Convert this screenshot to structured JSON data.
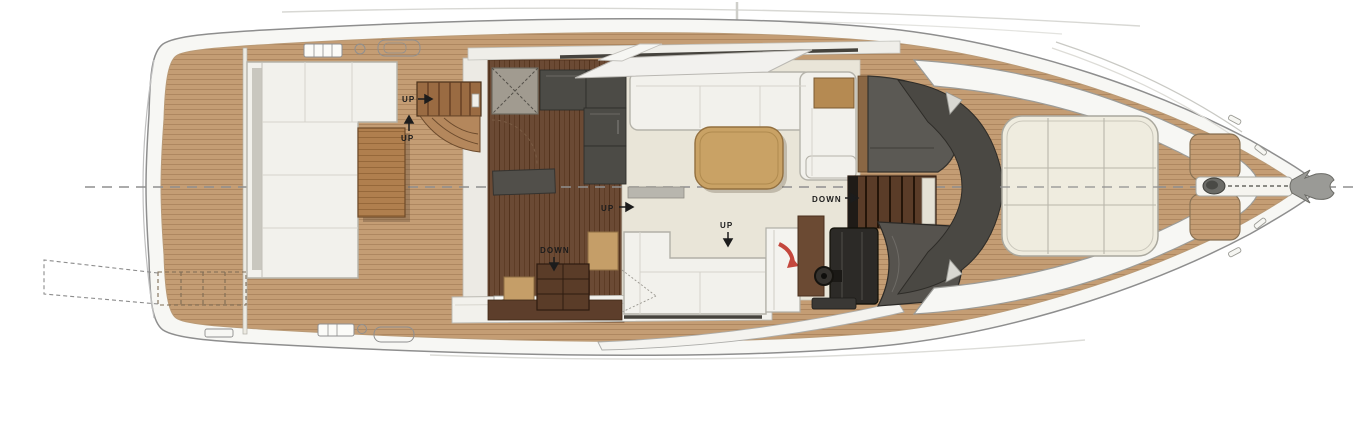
{
  "plan": {
    "type": "yacht-deck-floor-plan",
    "labels": {
      "up_flybridge": "UP",
      "up_swim": "UP",
      "up_galley": "UP",
      "up_cockpit": "UP",
      "down_cabins": "DOWN",
      "down_galley": "DOWN"
    },
    "icons": [
      "grill-icon",
      "burner-icon",
      "sink-icon",
      "skylight-hatch-icon",
      "steering-wheel-icon",
      "windlass-icon",
      "anchor-icon",
      "cleat-icon",
      "door-swing-arrow-icon",
      "up-arrow-icon",
      "down-arrow-icon"
    ],
    "colors": {
      "teak": "#c49d74",
      "teak-line": "#ae8760",
      "teak-dark": "#6b4a34",
      "teak-dark-line": "#53331d",
      "saloon-floor": "#e9e5d8",
      "fiberglass": "#f4f3ee",
      "counter": "#4c4b46",
      "sofa": "#f2f1ec",
      "table": "#c9a265",
      "stair": "#9a6b42",
      "stair-dark": "#5a3c28",
      "console": "#56534e",
      "helm-seat": "#2c2a27",
      "cabinet-brown": "#6b4a33",
      "sunpad": "#efecdf",
      "accent-red": "#c4473d",
      "outline": "#8e8e8e",
      "label": "#1c1c1c"
    }
  }
}
